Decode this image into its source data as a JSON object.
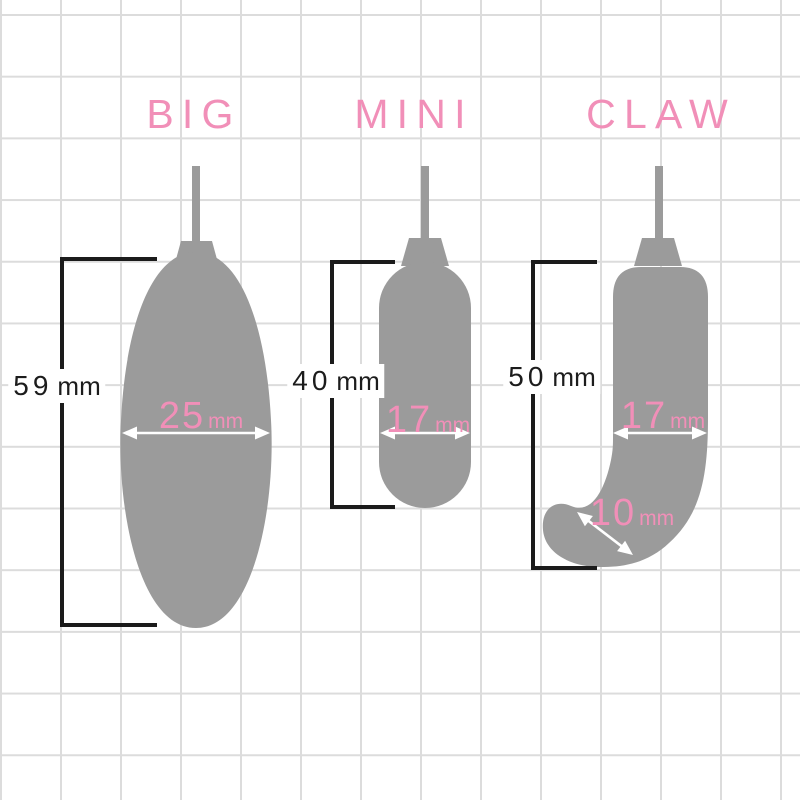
{
  "figure": {
    "description": "Product size comparison diagram",
    "unit": "mm"
  },
  "colors": {
    "background": "#ffffff",
    "grid_line": "#dcdcdc",
    "shape_gray": "#9b9b9b",
    "accent_pink": "#f18fb8",
    "measure_black": "#1b1b1b",
    "arrow_white": "#ffffff"
  },
  "products": [
    {
      "title": "BIG",
      "length": {
        "value": "59",
        "unit": "mm"
      },
      "width": {
        "value": "25",
        "unit": "mm"
      }
    },
    {
      "title": "MINI",
      "length": {
        "value": "40",
        "unit": "mm"
      },
      "width": {
        "value": "17",
        "unit": "mm"
      }
    },
    {
      "title": "CLAW",
      "length": {
        "value": "50",
        "unit": "mm"
      },
      "width": {
        "value": "17",
        "unit": "mm"
      },
      "tip_width": {
        "value": "10",
        "unit": "mm"
      }
    }
  ]
}
